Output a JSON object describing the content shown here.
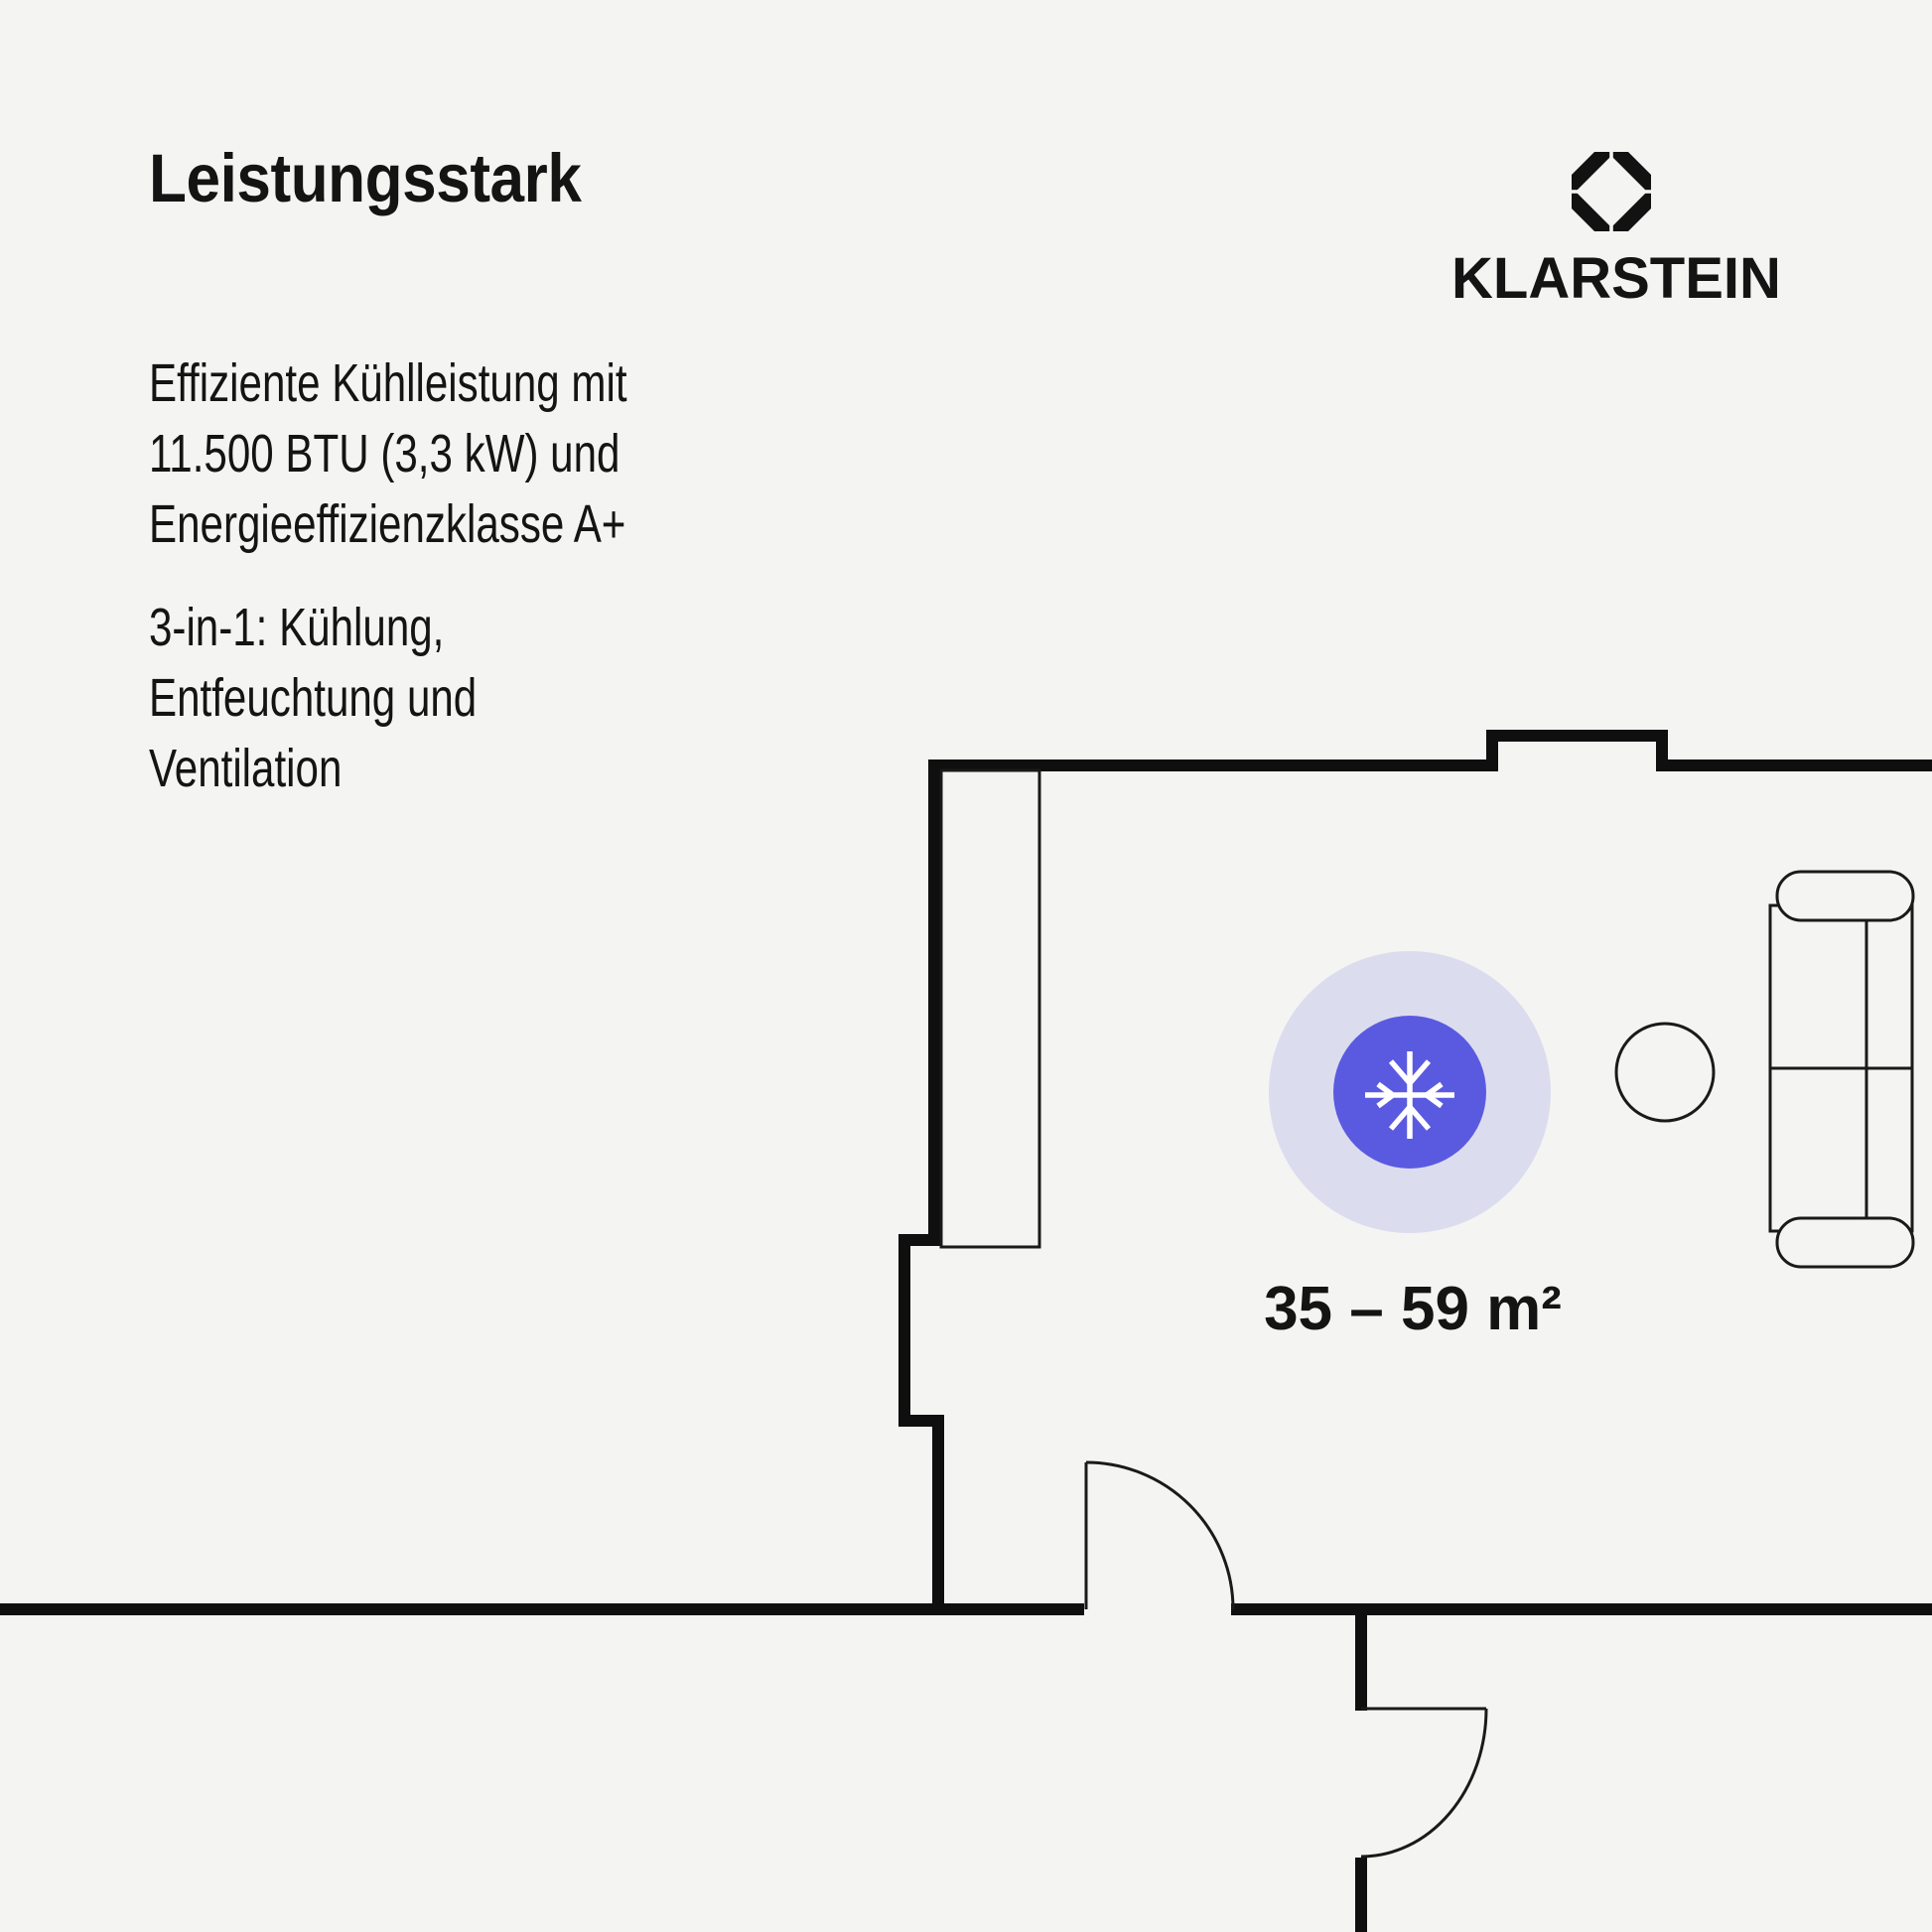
{
  "page": {
    "background_color": "#f4f4f2",
    "text_color": "#141414"
  },
  "header": {
    "title": "Leistungsstark"
  },
  "brand": {
    "name": "KLARSTEIN",
    "icon": "klarstein-octagon-diamond",
    "color": "#121212"
  },
  "paragraphs": [
    {
      "lines": [
        "Effiziente Kühlleistung mit",
        "11.500 BTU (3,3 kW) und",
        "Energieeffizienzklasse A+"
      ]
    },
    {
      "lines": [
        "3-in-1: Kühlung,",
        "Entfeuchtung und",
        "Ventilation"
      ]
    }
  ],
  "floorplan": {
    "area_label": "35 – 59 m²",
    "wall_color": "#0f0f0f",
    "line_color": "#1a1a1a",
    "badge": {
      "icon": "snowflake",
      "outer_color": "#dcdcef",
      "inner_color": "#5a5ae0",
      "glyph_color": "#ffffff"
    },
    "furniture": [
      "wardrobe",
      "sofa",
      "side-table"
    ],
    "doors": [
      "room-door",
      "hallway-door"
    ]
  }
}
